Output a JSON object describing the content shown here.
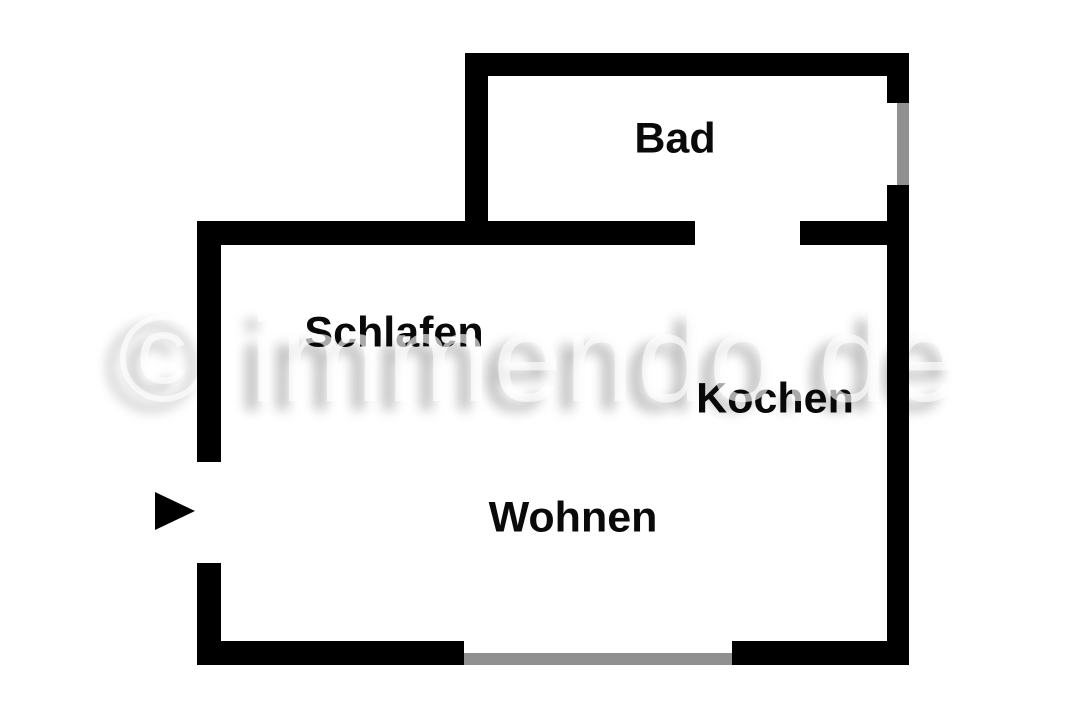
{
  "floorplan": {
    "watermark_text": "© immendo.de",
    "rooms": [
      {
        "id": "bad",
        "label": "Bad"
      },
      {
        "id": "schlafen",
        "label": "Schlafen"
      },
      {
        "id": "kochen",
        "label": "Kochen"
      },
      {
        "id": "wohnen",
        "label": "Wohnen"
      }
    ],
    "icons": {
      "entrance_arrow": "right-pointing-triangle"
    },
    "colors": {
      "wall": "#000000",
      "window": "#909090",
      "background": "#ffffff",
      "label": "#0a0a0a",
      "watermark": "#ffffff"
    }
  }
}
